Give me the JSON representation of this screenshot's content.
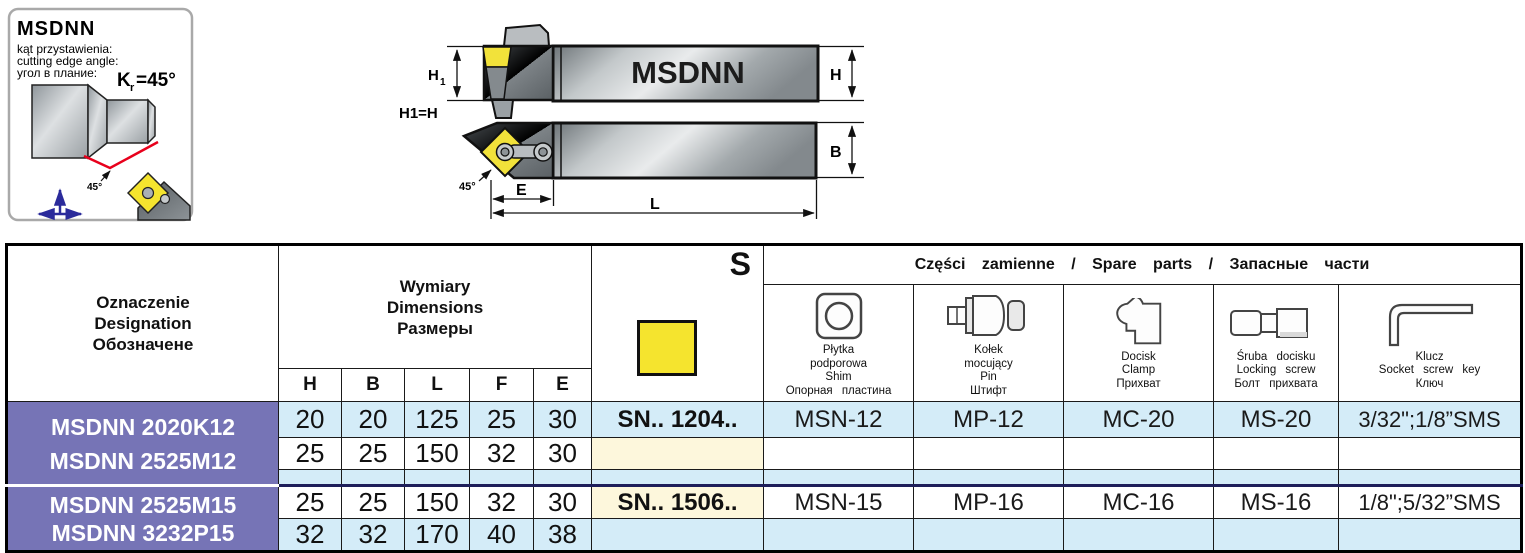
{
  "info_panel": {
    "title": "MSDNN",
    "line_pl": "kąt przystawienia:",
    "line_en": "cutting edge angle:",
    "line_ru": "угол в плание:",
    "angle_k": "K",
    "angle_sub": "r",
    "angle_eq": "=45°",
    "angle_callout": "45°"
  },
  "drawing": {
    "bar_label_side": "MSDNN",
    "note_h1_eq_h": "H1=H",
    "dim_h1_main": "H",
    "dim_h1_sub": "1",
    "dim_h": "H",
    "dim_b": "B",
    "dim_e": "E",
    "dim_l": "L",
    "angle_callout": "45°"
  },
  "table": {
    "headers": {
      "designation": [
        "Oznaczenie",
        "Designation",
        "Обозначене"
      ],
      "dimensions": [
        "Wymiary",
        "Dimensions",
        "Размеры"
      ],
      "dim_cols": [
        "H",
        "B",
        "L",
        "F",
        "E"
      ],
      "insert_symbol": "S",
      "spare_parts": "Części zamienne / Spare parts / Запасные части",
      "spare_cols": [
        {
          "icon": "shim-icon",
          "lines": [
            "Płytka",
            "podporowa",
            "Shim",
            "Опорная пластина"
          ]
        },
        {
          "icon": "pin-icon",
          "lines": [
            "Kołek",
            "mocujący",
            "Pin",
            "Штифт"
          ]
        },
        {
          "icon": "clamp-icon",
          "lines": [
            "Docisk",
            "Clamp",
            "Прихват"
          ]
        },
        {
          "icon": "locking-screw-icon",
          "lines": [
            "Śruba docisku",
            "Locking screw",
            "Болт прихвата"
          ]
        },
        {
          "icon": "hex-key-icon",
          "lines": [
            "Klucz",
            "Socket screw key",
            "Ключ"
          ]
        }
      ]
    },
    "groups": [
      {
        "models": [
          "MSDNN 2020K12",
          "MSDNN 2525M12"
        ],
        "dims": [
          [
            "20",
            "20",
            "125",
            "25",
            "30"
          ],
          [
            "25",
            "25",
            "150",
            "32",
            "30"
          ]
        ],
        "insert": "SN.. 1204..",
        "shim": "MSN-12",
        "pin": "MP-12",
        "clamp": "MC-20",
        "screw": "MS-20",
        "key": "3/32\";1/8”SMS"
      },
      {
        "models": [
          "MSDNN 2525M15",
          "MSDNN 3232P15"
        ],
        "dims": [
          [
            "25",
            "25",
            "150",
            "32",
            "30"
          ],
          [
            "32",
            "32",
            "170",
            "40",
            "38"
          ]
        ],
        "insert": "SN.. 1506..",
        "shim": "MSN-15",
        "pin": "MP-16",
        "clamp": "MC-16",
        "screw": "MS-16",
        "key": "1/8\";5/32”SMS"
      }
    ],
    "colors": {
      "designation_bg": "#7674b6",
      "row_blue": "#d4ecf8",
      "row_cream": "#fdf7dc",
      "insert_yellow": "#f5e42e",
      "group_divider": "#1e1e5a"
    }
  }
}
